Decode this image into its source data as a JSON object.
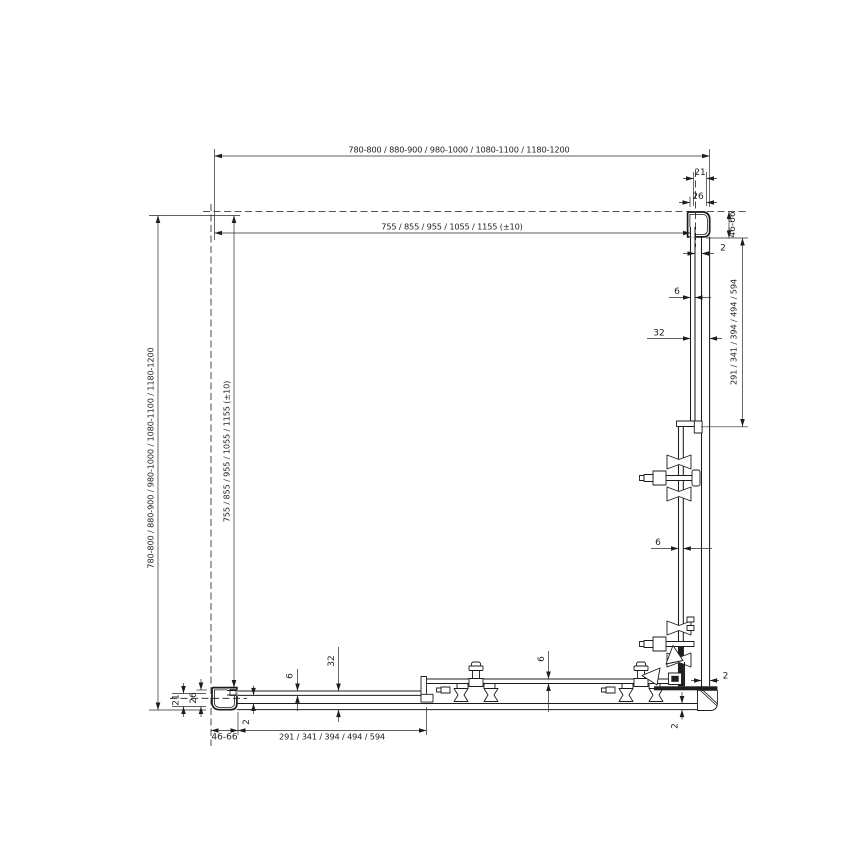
{
  "drawing": {
    "type": "technical-dimension-drawing",
    "subject": "corner sliding shower enclosure - plan view",
    "colors": {
      "line": "#1c1c1c",
      "background": "#ffffff"
    },
    "dims": {
      "width_overall": "780-800 / 880-900 / 980-1000 / 1080-1100 / 1180-1200",
      "width_glass": "755 / 855 / 955 / 1055 / 1155 (±10)",
      "height_overall": "780-800 / 880-900 / 980-1000 / 1080-1100 / 1180-1200",
      "height_glass": "755 / 855 / 955 / 1055 / 1155 (±10)",
      "top_right": {
        "profile_width": "21",
        "profile_face": "26",
        "wall_adjustment": "46-66",
        "glass_gap": "2"
      },
      "right_side": {
        "glass_thickness": "6",
        "offset": "32",
        "panel_length": "291 / 341 / 394 / 494 / 594",
        "door_glass_thickness": "6",
        "corner_gap_horizontal": "2",
        "corner_gap_vertical": "2"
      },
      "bottom_left": {
        "profile_width": "21",
        "profile_face": "26",
        "wall_adjustment": "46-66",
        "glass_gap": "2"
      },
      "bottom_side": {
        "glass_thickness": "6",
        "offset": "32",
        "panel_length": "291 / 341 / 394 / 494 / 594",
        "door_glass_thickness": "6"
      }
    }
  }
}
